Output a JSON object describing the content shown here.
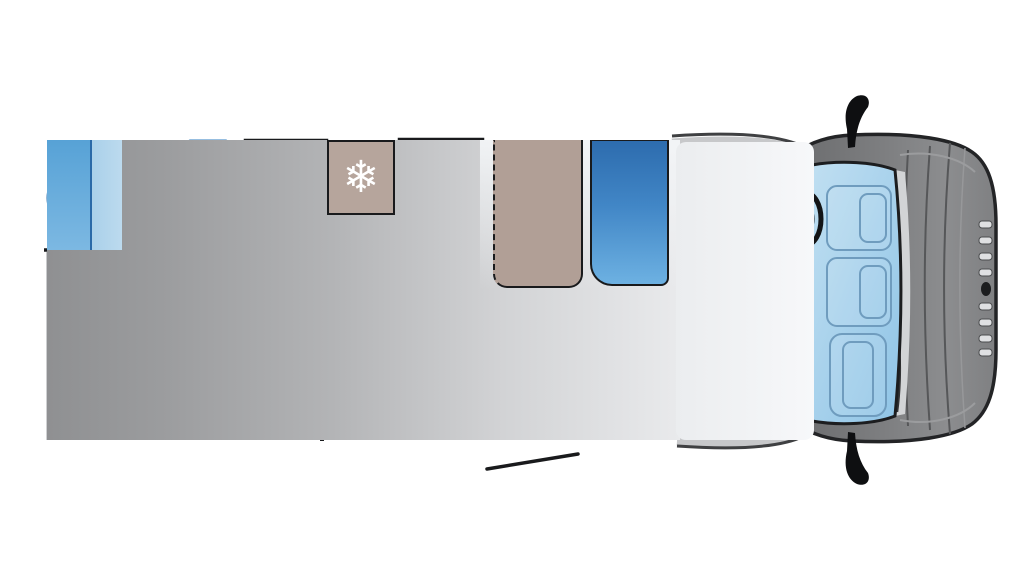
{
  "diagram": {
    "type": "motorhome-floorplan-top-view",
    "regions": [
      "washroom",
      "shower",
      "wardrobe",
      "fridge",
      "dinette-seats",
      "table",
      "drop-down-bed-outline",
      "rear-bed",
      "kitchen",
      "entrance-door",
      "travel-seat",
      "cab-seats",
      "steering-wheel",
      "windscreen"
    ]
  },
  "icons": {
    "snowflake": "❄",
    "clothes-rail": "rail-with-bars",
    "shower-spray": "spray-lines",
    "hob-burners": "three-circles"
  },
  "palette": {
    "outline": "#191a1c",
    "seat-top": "#2d6cae",
    "seat-bot": "#6db1e2",
    "taupe": "#b19f96",
    "taupe-light": "#b6a59c",
    "cream": "#ece6da",
    "bed": "#d0d1d3",
    "bathroom": "#bcdaee",
    "cabinet": "#57a2d6",
    "shower": "#a9c0d2",
    "blue-line": "#2f7cc0",
    "orange": "#e6995f",
    "cab-body": "#7e7f81",
    "windscreen": "#9fcdea",
    "floor-dark": "#8f9092",
    "floor-light": "#e9eaec"
  }
}
